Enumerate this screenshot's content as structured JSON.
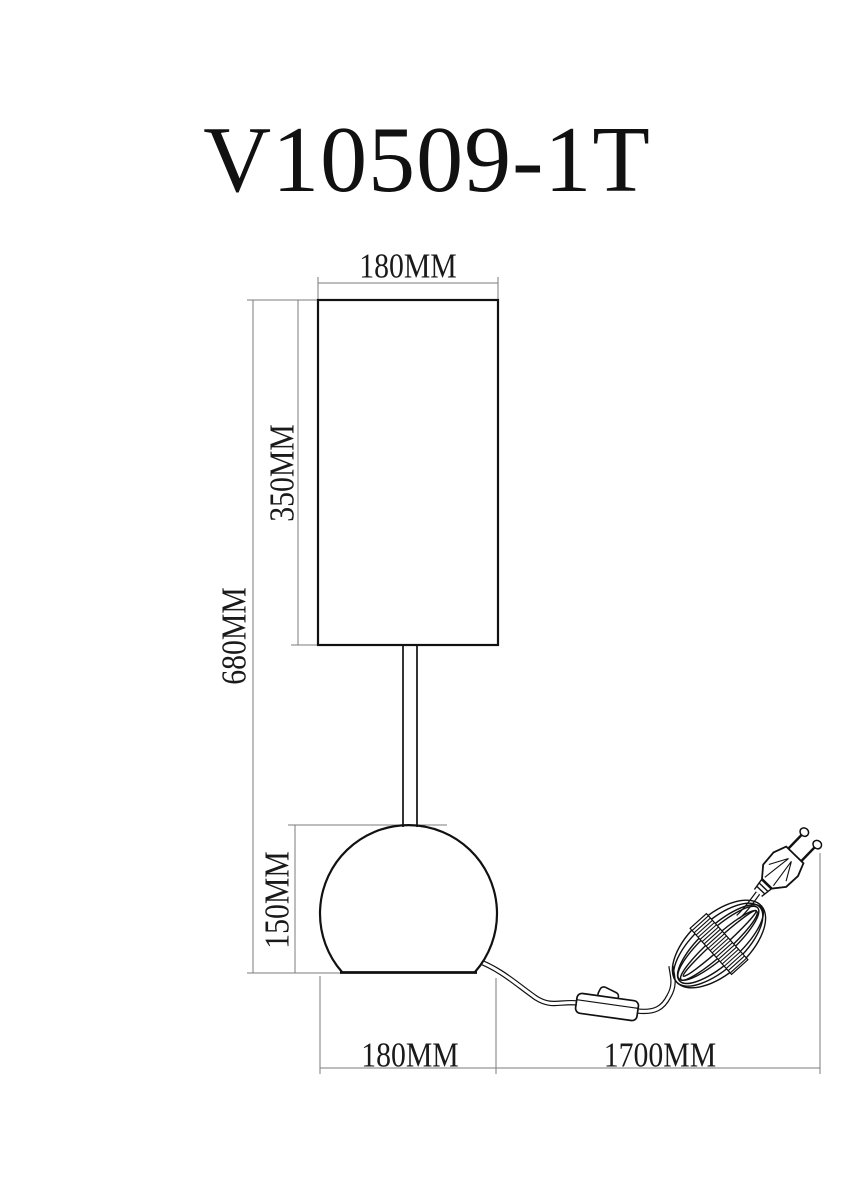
{
  "title": "V10509-1T",
  "dimensions": {
    "shade_width": "180MM",
    "shade_height": "350MM",
    "lamp_height": "680MM",
    "base_height": "150MM",
    "base_width": "180MM",
    "cord_length": "1700MM"
  },
  "colors": {
    "object_line": "#111111",
    "dimension_line": "#7b7b7b",
    "text": "#1a1a1a",
    "background": "#ffffff"
  }
}
